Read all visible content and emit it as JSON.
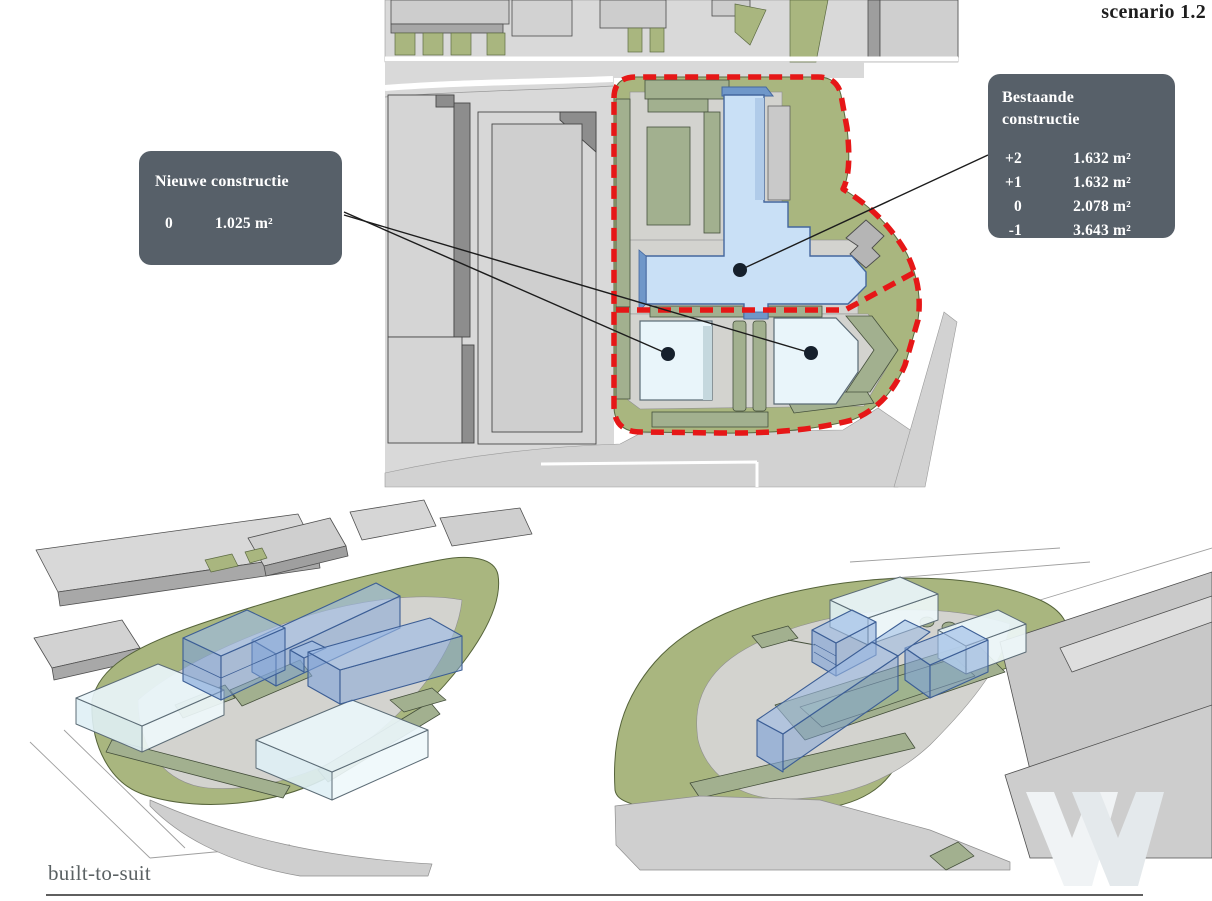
{
  "header": {
    "scenario_label": "scenario 1.2"
  },
  "callouts": {
    "new_construction": {
      "title": "Nieuwe constructie",
      "rows": [
        {
          "level": "0",
          "area": "1.025 m²"
        }
      ]
    },
    "existing_construction": {
      "title_lines": [
        "Bestaande",
        "constructie"
      ],
      "rows": [
        {
          "level": "+2",
          "area": "1.632 m²"
        },
        {
          "level": "+1",
          "area": "1.632 m²"
        },
        {
          "level": "0",
          "area": "2.078 m²"
        },
        {
          "level": "-1",
          "area": "3.643 m²"
        }
      ]
    }
  },
  "footer": {
    "label": "built-to-suit"
  },
  "watermark_icon": "w-logo",
  "colors": {
    "existing_building_blue": "#c9e0f6",
    "new_building_pale": "#e9f5fa",
    "landscape_green": "#a9b67f",
    "hedge_sage": "#a2b08f",
    "plot_boundary_red": "#e61717",
    "callout_background": "#576069"
  }
}
